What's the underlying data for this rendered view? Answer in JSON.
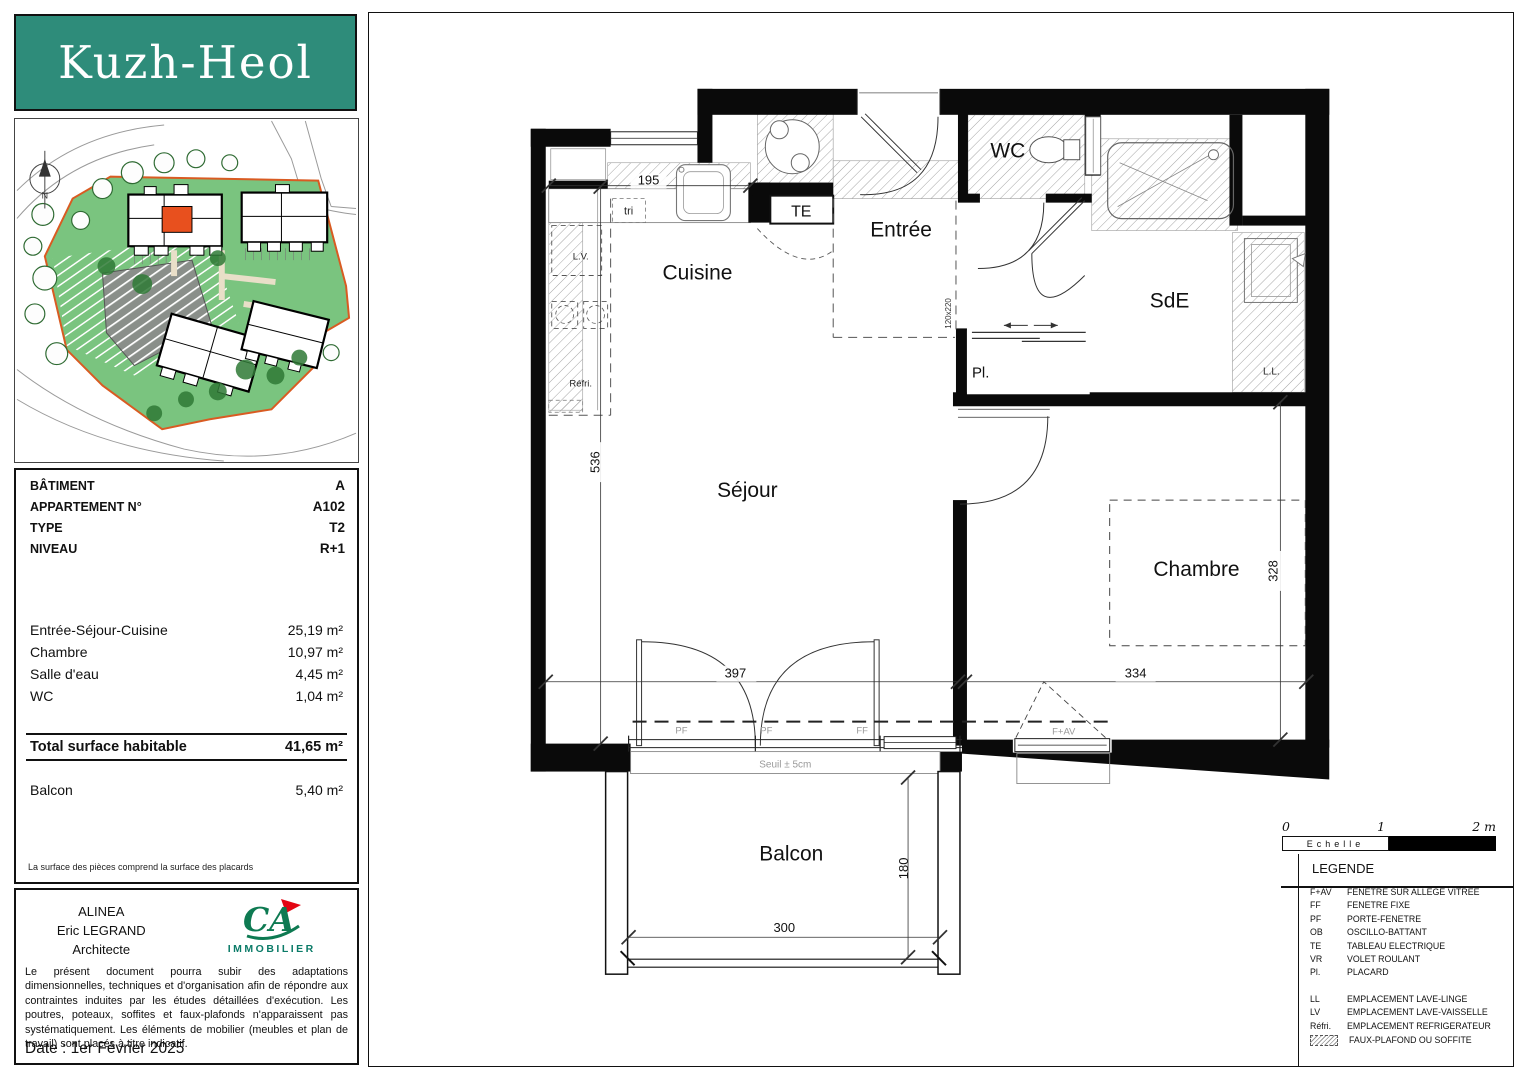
{
  "logo": {
    "text": "Kuzh-Heol",
    "bg_color": "#2E8C7A"
  },
  "site_plan": {
    "compass_label": "N",
    "site_color": "#7AC47F",
    "boundary_color": "#D95B22",
    "highlight_color": "#E8501E"
  },
  "info": {
    "rows": [
      {
        "label": "BÂTIMENT",
        "value": "A"
      },
      {
        "label": "APPARTEMENT N°",
        "value": "A102"
      },
      {
        "label": "TYPE",
        "value": "T2"
      },
      {
        "label": "NIVEAU",
        "value": "R+1"
      }
    ],
    "areas": [
      {
        "label": "Entrée-Séjour-Cuisine",
        "value": "25,19 m²"
      },
      {
        "label": "Chambre",
        "value": "10,97 m²"
      },
      {
        "label": "Salle d'eau",
        "value": "4,45 m²"
      },
      {
        "label": "WC",
        "value": "1,04 m²"
      }
    ],
    "total": {
      "label": "Total surface habitable",
      "value": "41,65 m²"
    },
    "balcony": {
      "label": "Balcon",
      "value": "5,40 m²"
    },
    "footnote": "La surface des pièces comprend la surface des placards"
  },
  "architect": {
    "line1": "ALINEA",
    "line2": "Eric LEGRAND",
    "line3": "Architecte",
    "brand": "CA",
    "brand_sub": "IMMOBILIER",
    "disclaimer": "Le présent document pourra subir des adaptations dimensionnelles, techniques et d'organisation afin de répondre aux contraintes induites par les études détaillées d'exécution. Les poutres, poteaux, soffites et faux-plafonds n'apparaissent pas systématiquement. Les éléments de mobilier (meubles et plan de travail) sont placés à titre indicatif.",
    "date": "Date : 1er Février 2025"
  },
  "plan": {
    "rooms": {
      "cuisine": "Cuisine",
      "entree": "Entrée",
      "wc": "WC",
      "sde": "SdE",
      "sejour": "Séjour",
      "chambre": "Chambre",
      "balcon": "Balcon"
    },
    "labels": {
      "te": "TE",
      "tri": "tri",
      "lv": "L.V.",
      "refri": "Réfri.",
      "pl": "Pl.",
      "ll": "L.L.",
      "seuil": "Seuil ± 5cm",
      "door_size": "120x220"
    },
    "dims": {
      "d195": "195",
      "d536": "536",
      "d397": "397",
      "d334": "334",
      "d328": "328",
      "d300": "300",
      "d180": "180"
    },
    "windows": {
      "pf1": "PF",
      "pf2": "PF",
      "ff": "FF",
      "fav": "F+AV"
    }
  },
  "scale": {
    "t0": "0",
    "t1": "1",
    "t2": "2 m",
    "label": "Echelle"
  },
  "legend": {
    "title": "LEGENDE",
    "items": [
      {
        "abbr": "F+AV",
        "label": "FENETRE SUR ALLEGE VITREE"
      },
      {
        "abbr": "FF",
        "label": "FENETRE FIXE"
      },
      {
        "abbr": "PF",
        "label": "PORTE-FENETRE"
      },
      {
        "abbr": "OB",
        "label": "OSCILLO-BATTANT"
      },
      {
        "abbr": "TE",
        "label": "TABLEAU ELECTRIQUE"
      },
      {
        "abbr": "VR",
        "label": "VOLET ROULANT"
      },
      {
        "abbr": "Pl.",
        "label": "PLACARD"
      }
    ],
    "items2": [
      {
        "abbr": "LL",
        "label": "EMPLACEMENT LAVE-LINGE"
      },
      {
        "abbr": "LV",
        "label": "EMPLACEMENT LAVE-VAISSELLE"
      },
      {
        "abbr": "Réfri.",
        "label": "EMPLACEMENT REFRIGERATEUR"
      }
    ],
    "faux_plafond": "FAUX-PLAFOND OU SOFFITE"
  }
}
